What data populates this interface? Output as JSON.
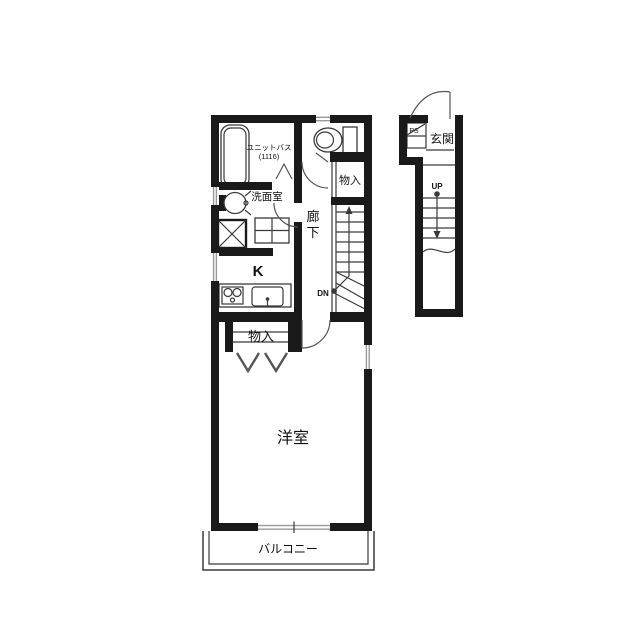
{
  "floorplan": {
    "title": "apartment-floor-plan",
    "labels": {
      "unit_bath": "ユニットバス",
      "unit_bath_size": "(1116)",
      "washroom": "洗面室",
      "kitchen": "K",
      "corridor_char1": "廊",
      "corridor_char2": "下",
      "storage_upper": "物入",
      "storage_lower": "物入",
      "western_room": "洋室",
      "balcony": "バルコニー",
      "entrance": "玄関",
      "pipe_space": "PS",
      "stairs_up": "UP",
      "stairs_down": "DN"
    },
    "colors": {
      "wall": "#1a1a1a",
      "line": "#3a3a3a",
      "door": "#555555",
      "window": "#9a9a9a",
      "text": "#111111",
      "bg": "#ffffff"
    }
  }
}
